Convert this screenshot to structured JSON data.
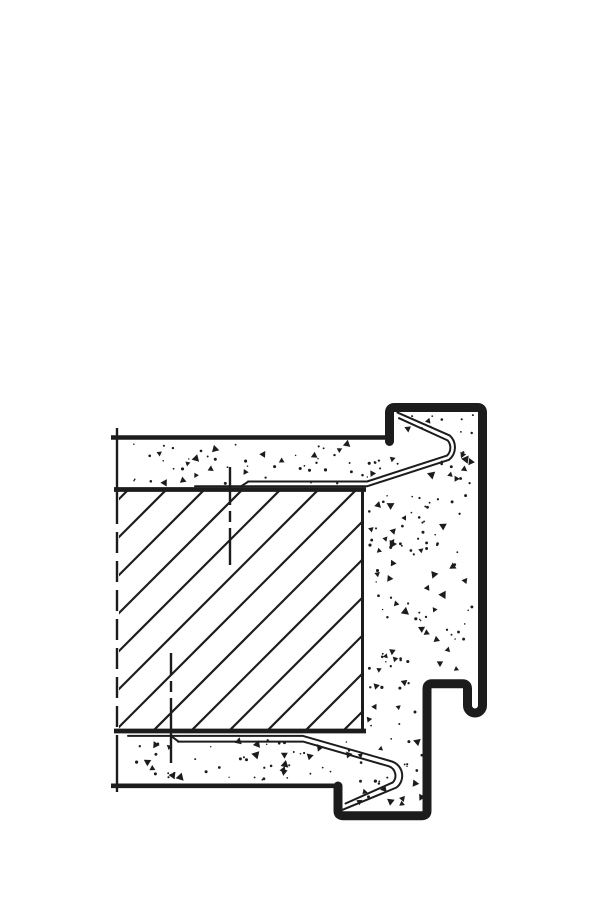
{
  "page": {
    "background": "#ffffff",
    "width": 600,
    "height": 900,
    "description": "Technical section detail drawing of a steel door frame profile set around a masonry wall end with plaster faces and mortar fill. No text labels are present in the drawing."
  },
  "drawing": {
    "ink": "#1c1c1c",
    "background": "#ffffff",
    "frame_profile": {
      "stroke_width": 9,
      "path": "M389.5,441.5 L389.5,412.5 Q389.5,407.5 394.5,407.5 L477.5,407.5 Q482.5,407.5 482.5,412.5 L482.5,705.5 A7.5,7.5 0 0 1 467.5,705.5 L467.5,688.8 Q467.5,683.8 462.5,683.8 L432,683.8 Q427,683.8 427,688.8 L427,810.7 Q427,815.7 422,815.7 L343,815.7 Q338,815.7 338,810.7 L338,786"
    },
    "wall_lines": [
      {
        "name": "plaster-face-top-line",
        "d": "M111,437.5 L386,437.5",
        "w": 4.6,
        "dash": ""
      },
      {
        "name": "masonry-top-line",
        "d": "M114,489.5 L366,489.5",
        "w": 4.8,
        "dash": ""
      },
      {
        "name": "masonry-bottom-line",
        "d": "M114,731 L366,731",
        "w": 4.8,
        "dash": ""
      },
      {
        "name": "plaster-face-bottom-line",
        "d": "M111,785.8 L336.5,785.8",
        "w": 4.6,
        "dash": ""
      },
      {
        "name": "masonry-right-edge-line",
        "d": "M362.5,491 L362.5,729.5",
        "w": 3,
        "dash": ""
      }
    ],
    "wall_cut_edge": [
      {
        "d": "M117,428 L117,503",
        "w": 2.4,
        "dash": ""
      },
      {
        "d": "M117,503 L117,741",
        "w": 2.4,
        "dash": "21 8"
      },
      {
        "d": "M117,741 L117,792",
        "w": 2.4,
        "dash": ""
      }
    ],
    "anchor_centerlines": [
      {
        "d": "M230,467 L230,565",
        "w": 2.4,
        "dash": "38 6 11 6 60"
      },
      {
        "d": "M171,653 L171,763",
        "w": 2.4,
        "dash": "22 6 11 6 80"
      }
    ],
    "sheet_top": [
      {
        "d": "M195,486.3 L367,486.3 L449,459.8 A16,16 0 0 0 449.6,435.4 L397.5,412.6",
        "w": 2
      },
      {
        "d": "M248,481.5 L367,481.5 L447,455.6 A11,11 0 0 0 447.6,440.4 L399,418.2",
        "w": 2
      },
      {
        "d": "M248.5,481.5 L241,486.3",
        "w": 2
      }
    ],
    "sheet_bottom": [
      {
        "d": "M128,735.9 L303,735.9 L392,761.5 A15,15 0 0 1 396.5,787.5 L342.5,809.8",
        "w": 2
      },
      {
        "d": "M178,741.6 L303,741.6 L389,766.3 A10,10 0 0 1 392.8,782.4 L345.5,803.5",
        "w": 2
      },
      {
        "d": "M178.5,741.6 L171,735.9",
        "w": 2
      }
    ],
    "hatch": {
      "clip": [
        119,
        491,
        242,
        239
      ],
      "base_y": 731,
      "rise": 245,
      "phase": 39,
      "spacing": 38,
      "w": 2.2,
      "k_min": -4,
      "k_max": 8
    },
    "stipple": {
      "seed": 123457,
      "triangle_ratio": 0.27,
      "regions": [
        [
          121,
          444,
          262,
          40,
          55
        ],
        [
          396,
          415,
          78,
          22,
          11
        ],
        [
          368,
          446,
          104,
          228,
          112
        ],
        [
          368,
          678,
          54,
          49,
          13
        ],
        [
          121,
          737,
          214,
          44,
          50
        ],
        [
          342,
          737,
          82,
          68,
          28
        ]
      ]
    }
  }
}
